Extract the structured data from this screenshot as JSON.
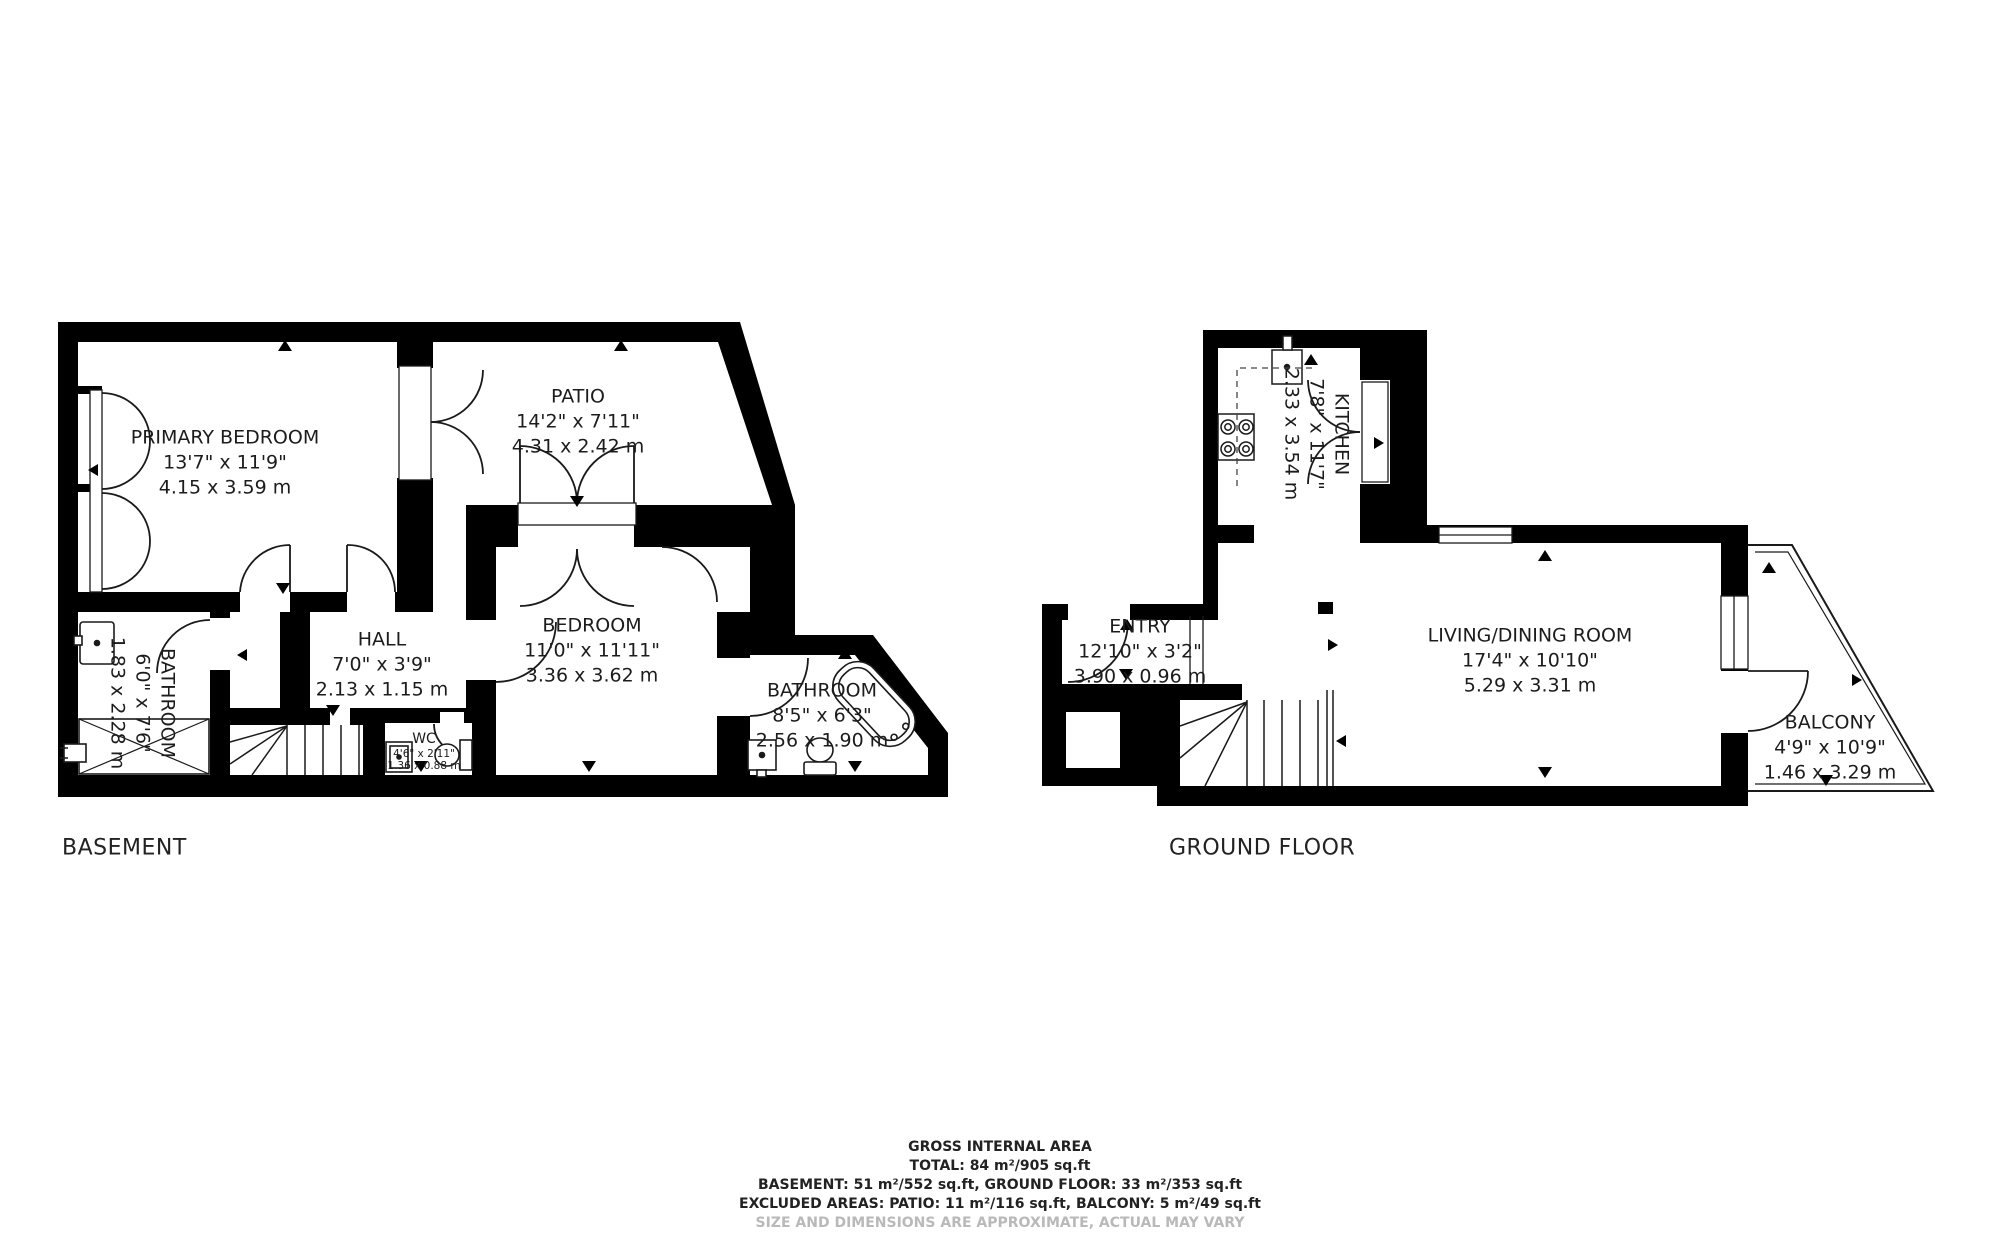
{
  "floors": [
    {
      "id": "basement",
      "label": "BASEMENT",
      "rooms": [
        {
          "id": "primary-bedroom",
          "name": "PRIMARY BEDROOM",
          "dims_ft": "13'7\" x 11'9\"",
          "dims_m": "4.15 x 3.59 m"
        },
        {
          "id": "patio",
          "name": "PATIO",
          "dims_ft": "14'2\" x 7'11\"",
          "dims_m": "4.31 x 2.42 m"
        },
        {
          "id": "hall",
          "name": "HALL",
          "dims_ft": "7'0\" x 3'9\"",
          "dims_m": "2.13 x 1.15 m"
        },
        {
          "id": "bedroom",
          "name": "BEDROOM",
          "dims_ft": "11'0\" x 11'11\"",
          "dims_m": "3.36 x 3.62 m"
        },
        {
          "id": "bathroom-left",
          "name": "BATHROOM",
          "dims_ft": "6'0\" x 7'6\"",
          "dims_m": "1.83 x 2.28 m"
        },
        {
          "id": "wc",
          "name": "WC",
          "dims_ft": "4'6\" x 2'11\"",
          "dims_m": "1.36 x 0.88 m"
        },
        {
          "id": "bathroom-right",
          "name": "BATHROOM",
          "dims_ft": "8'5\" x 6'3\"",
          "dims_m": "2.56 x 1.90 m"
        }
      ]
    },
    {
      "id": "ground",
      "label": "GROUND FLOOR",
      "rooms": [
        {
          "id": "kitchen",
          "name": "KITCHEN",
          "dims_ft": "7'8\" x 11'7\"",
          "dims_m": "2.33 x 3.54 m"
        },
        {
          "id": "entry",
          "name": "ENTRY",
          "dims_ft": "12'10\" x 3'2\"",
          "dims_m": "3.90 x 0.96 m"
        },
        {
          "id": "living-dining",
          "name": "LIVING/DINING ROOM",
          "dims_ft": "17'4\" x 10'10\"",
          "dims_m": "5.29 x 3.31 m"
        },
        {
          "id": "balcony",
          "name": "BALCONY",
          "dims_ft": "4'9\" x 10'9\"",
          "dims_m": "1.46 x 3.29 m"
        }
      ]
    }
  ],
  "summary": {
    "title": "GROSS INTERNAL AREA",
    "total_line": "TOTAL: 84 m²/905 sq.ft",
    "floors_line": "BASEMENT: 51 m²/552 sq.ft, GROUND FLOOR: 33 m²/353 sq.ft",
    "excluded_line": "EXCLUDED AREAS: PATIO: 11 m²/116 sq.ft, BALCONY: 5 m²/49 sq.ft",
    "disclaimer": "SIZE AND DIMENSIONS ARE APPROXIMATE, ACTUAL MAY VARY"
  },
  "colors": {
    "wall": "#000000",
    "line": "#1a1a1a",
    "disclaimer": "#b9b9b9",
    "background": "#ffffff"
  },
  "icons": {
    "stove": "four-burner-hob",
    "sink": "basin-with-dot",
    "toilet": "tank-and-bowl",
    "bathtub": "rounded-tub",
    "shower": "crossed-box",
    "stairs": "treads-with-winders",
    "door": "quarter-arc",
    "window": "double-line",
    "direction-marker": "solid-triangle"
  }
}
